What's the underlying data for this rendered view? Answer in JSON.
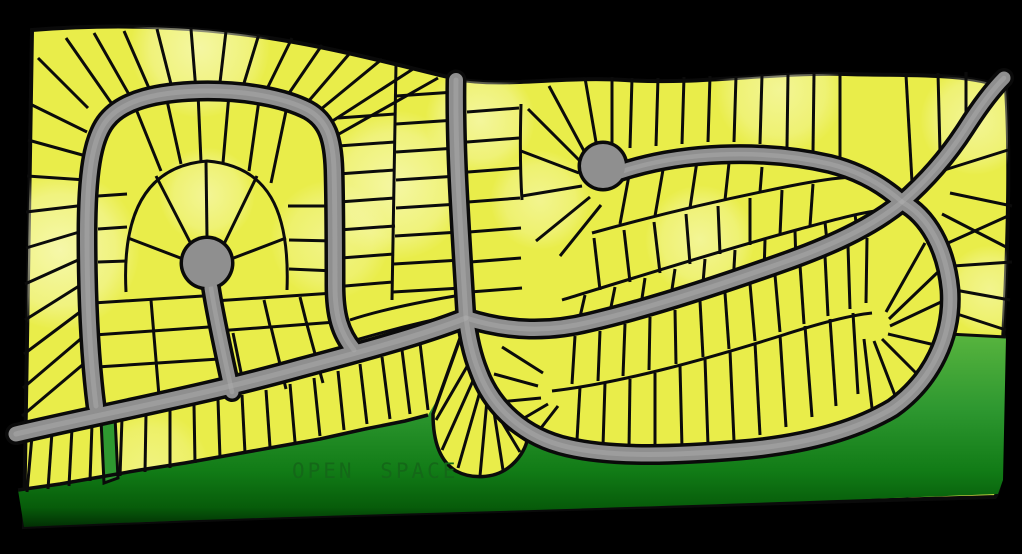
{
  "open_space": {
    "label": "OPEN SPACE"
  },
  "colors": {
    "background": "#000000",
    "lot_fill": "#e9ed4a",
    "lot_line": "#0b0b0b",
    "pale": "#fbfcd2",
    "road_fill": "#8f8f8f",
    "road_casing": "#0a0a0a",
    "road_highlight": "#aaaaaa",
    "green_mid": "#2e9830",
    "label_text": "#146818"
  },
  "map": {
    "width": 1022,
    "height": 554,
    "label_pos": {
      "x": 292,
      "y": 478
    },
    "plat_path": "M 32 30 C 120 23 205 27 282 40 C 342 50 402 66 456 79 C 505 88 560 76 625 80 C 700 85 770 72 845 74 C 905 76 965 72 1006 88 C 1010 150 1008 240 1004 320 C 1001 380 1000 430 1000 472 C 1000 483 999 492 995 497 C 900 499 700 505 500 511 C 350 515 180 520 24 527 C 25 440 28 250 32 30 Z",
    "green_path": "M 18 490 L 60 484 L 100 477 L 140 470 L 185 463 L 230 455 L 275 447 L 320 439 L 365 429 L 405 421 L 428 415 L 437 400 L 450 382 L 459 352 L 463 330 L 470 352 L 479 382 L 493 410 L 516 432 L 546 446 L 582 454 L 622 457 L 667 456 L 712 450 L 757 441 L 801 428 L 841 411 L 876 389 L 906 358 L 926 330 L 948 333 L 1006 337 L 1003 480 L 998 494 C 900 498 700 505 500 511 C 350 515 180 520 24 527 Z",
    "green_stops": [
      [
        "0%",
        "#5ab63f"
      ],
      [
        "40%",
        "#2e9830"
      ],
      [
        "72%",
        "#117b16"
      ],
      [
        "90%",
        "#075c0a"
      ],
      [
        "100%",
        "#022f04"
      ]
    ],
    "green_strip_path": "M 101 420 L 115 417 L 118 478 L 104 483 Z",
    "racetrack_path": "M 466 318 C 510 332 550 332 590 322 C 650 308 720 285 790 260 C 840 242 875 224 902 202 C 928 216 946 248 950 290 C 953 336 932 380 893 408 C 853 432 800 445 740 450 C 680 455 615 458 568 447 C 523 437 492 407 479 372 C 471 352 468 334 466 318 Z",
    "fan_path": "M 463 330 L 433 414 C 433 443 441 462 456 471 C 471 479 493 479 508 468 C 519 460 525 449 527 441 L 510 429 C 499 409 489 389 483 369 Z",
    "green_boundary_path": "M 18 490 L 60 484 L 100 477 L 140 470 L 185 463 L 230 455 L 275 447 L 320 439 L 365 429 L 405 421 L 428 415",
    "block_lines": [
      "M 126 292 C 122 215 145 166 207 161 C 268 166 290 210 287 290",
      "M 552 391 C 620 383 700 361 780 336 C 820 323 852 315 872 313",
      "M 562 300 C 640 276 730 248 800 229 C 830 221 855 214 875 211",
      "M 592 233 C 660 214 730 198 790 186 C 815 181 835 178 852 177",
      "M 396 64 L 392 300",
      "M 350 320 C 380 310 420 302 455 296",
      "M 356 340 C 390 330 430 320 462 314",
      "M 521 104 C 520 140 520 170 522 200",
      "M 948 334 L 1006 337"
    ],
    "lot_lines": [
      [
        88,
        108,
        38,
        58
      ],
      [
        87,
        132,
        30,
        104
      ],
      [
        86,
        156,
        28,
        140
      ],
      [
        86,
        180,
        27,
        176
      ],
      [
        86,
        205,
        26,
        212
      ],
      [
        86,
        230,
        26,
        248
      ],
      [
        87,
        256,
        25,
        284
      ],
      [
        87,
        281,
        25,
        320
      ],
      [
        88,
        306,
        24,
        354
      ],
      [
        90,
        331,
        23,
        388
      ],
      [
        93,
        356,
        22,
        416
      ],
      [
        112,
        104,
        66,
        38
      ],
      [
        131,
        98,
        94,
        33
      ],
      [
        152,
        95,
        124,
        31
      ],
      [
        173,
        92,
        157,
        29
      ],
      [
        196,
        91,
        191,
        29
      ],
      [
        219,
        91,
        226,
        31
      ],
      [
        241,
        93,
        259,
        34
      ],
      [
        263,
        97,
        292,
        38
      ],
      [
        283,
        102,
        322,
        45
      ],
      [
        301,
        110,
        350,
        53
      ],
      [
        309,
        119,
        382,
        59
      ],
      [
        317,
        131,
        413,
        69
      ],
      [
        323,
        143,
        438,
        78
      ],
      [
        338,
        118,
        395,
        114
      ],
      [
        338,
        146,
        395,
        142
      ],
      [
        338,
        174,
        395,
        170
      ],
      [
        339,
        202,
        395,
        198
      ],
      [
        339,
        230,
        395,
        226
      ],
      [
        341,
        258,
        394,
        254
      ],
      [
        345,
        286,
        393,
        282
      ],
      [
        396,
        96,
        455,
        92
      ],
      [
        396,
        124,
        456,
        120
      ],
      [
        396,
        152,
        457,
        148
      ],
      [
        396,
        180,
        458,
        176
      ],
      [
        396,
        208,
        459,
        204
      ],
      [
        395,
        236,
        460,
        232
      ],
      [
        394,
        264,
        461,
        260
      ],
      [
        393,
        292,
        462,
        288
      ],
      [
        207,
        237,
        206,
        162
      ],
      [
        191,
        244,
        156,
        176
      ],
      [
        183,
        259,
        128,
        238
      ],
      [
        224,
        244,
        257,
        176
      ],
      [
        231,
        259,
        286,
        238
      ],
      [
        93,
        303,
        203,
        296
      ],
      [
        94,
        335,
        209,
        327
      ],
      [
        97,
        367,
        219,
        359
      ],
      [
        151,
        300,
        159,
        396
      ],
      [
        214,
        301,
        334,
        293
      ],
      [
        217,
        331,
        336,
        322
      ],
      [
        264,
        300,
        270,
        326
      ],
      [
        300,
        297,
        306,
        321
      ],
      [
        233,
        333,
        245,
        392
      ],
      [
        271,
        327,
        286,
        389
      ],
      [
        306,
        321,
        323,
        383
      ],
      [
        98,
        196,
        127,
        194
      ],
      [
        98,
        229,
        127,
        227
      ],
      [
        98,
        262,
        127,
        261
      ],
      [
        136,
        109,
        161,
        171
      ],
      [
        166,
        96,
        181,
        164
      ],
      [
        198,
        93,
        201,
        162
      ],
      [
        229,
        94,
        223,
        163
      ],
      [
        259,
        100,
        249,
        171
      ],
      [
        286,
        111,
        271,
        183
      ],
      [
        333,
        206,
        288,
        206
      ],
      [
        335,
        241,
        289,
        240
      ],
      [
        335,
        271,
        289,
        269
      ],
      [
        32,
        436,
        27,
        492
      ],
      [
        52,
        432,
        48,
        489
      ],
      [
        72,
        428,
        69,
        486
      ],
      [
        92,
        424,
        90,
        481
      ],
      [
        122,
        418,
        120,
        476
      ],
      [
        146,
        414,
        145,
        472
      ],
      [
        170,
        410,
        170,
        468
      ],
      [
        194,
        405,
        195,
        463
      ],
      [
        218,
        400,
        220,
        458
      ],
      [
        242,
        395,
        245,
        453
      ],
      [
        266,
        390,
        270,
        447
      ],
      [
        290,
        384,
        295,
        442
      ],
      [
        314,
        378,
        320,
        436
      ],
      [
        338,
        371,
        344,
        430
      ],
      [
        360,
        364,
        367,
        424
      ],
      [
        382,
        357,
        390,
        419
      ],
      [
        402,
        350,
        410,
        414
      ],
      [
        420,
        343,
        428,
        410
      ],
      [
        472,
        358,
        436,
        420
      ],
      [
        476,
        374,
        442,
        450
      ],
      [
        481,
        388,
        458,
        468
      ],
      [
        487,
        400,
        480,
        476
      ],
      [
        494,
        412,
        503,
        470
      ],
      [
        502,
        422,
        520,
        452
      ],
      [
        575,
        336,
        572,
        384
      ],
      [
        600,
        331,
        598,
        381
      ],
      [
        625,
        324,
        623,
        376
      ],
      [
        650,
        317,
        649,
        370
      ],
      [
        675,
        310,
        676,
        364
      ],
      [
        700,
        301,
        703,
        357
      ],
      [
        725,
        293,
        729,
        349
      ],
      [
        750,
        284,
        755,
        341
      ],
      [
        775,
        275,
        780,
        332
      ],
      [
        800,
        265,
        804,
        324
      ],
      [
        825,
        256,
        828,
        316
      ],
      [
        848,
        246,
        850,
        309
      ],
      [
        867,
        238,
        866,
        303
      ],
      [
        580,
        387,
        577,
        440
      ],
      [
        605,
        383,
        603,
        446
      ],
      [
        630,
        379,
        629,
        449
      ],
      [
        655,
        373,
        655,
        449
      ],
      [
        680,
        366,
        682,
        448
      ],
      [
        705,
        359,
        708,
        445
      ],
      [
        730,
        351,
        734,
        441
      ],
      [
        755,
        343,
        760,
        435
      ],
      [
        780,
        335,
        786,
        427
      ],
      [
        805,
        326,
        812,
        417
      ],
      [
        830,
        319,
        836,
        406
      ],
      [
        853,
        313,
        858,
        394
      ],
      [
        543,
        373,
        502,
        347
      ],
      [
        538,
        386,
        494,
        374
      ],
      [
        541,
        398,
        499,
        402
      ],
      [
        548,
        404,
        514,
        424
      ],
      [
        558,
        406,
        534,
        437
      ],
      [
        886,
        312,
        925,
        243
      ],
      [
        889,
        319,
        938,
        272
      ],
      [
        890,
        326,
        941,
        302
      ],
      [
        888,
        334,
        935,
        345
      ],
      [
        882,
        339,
        918,
        375
      ],
      [
        874,
        341,
        896,
        398
      ],
      [
        864,
        339,
        872,
        408
      ],
      [
        585,
        295,
        577,
        330
      ],
      [
        615,
        287,
        608,
        322
      ],
      [
        645,
        278,
        640,
        312
      ],
      [
        675,
        269,
        670,
        303
      ],
      [
        705,
        259,
        702,
        295
      ],
      [
        735,
        250,
        733,
        285
      ],
      [
        765,
        240,
        764,
        274
      ],
      [
        795,
        231,
        796,
        263
      ],
      [
        825,
        222,
        828,
        252
      ],
      [
        855,
        214,
        858,
        240
      ],
      [
        600,
        290,
        594,
        238
      ],
      [
        630,
        282,
        624,
        230
      ],
      [
        660,
        273,
        654,
        222
      ],
      [
        690,
        264,
        686,
        214
      ],
      [
        720,
        254,
        718,
        206
      ],
      [
        750,
        245,
        750,
        198
      ],
      [
        780,
        235,
        782,
        190
      ],
      [
        810,
        226,
        813,
        184
      ],
      [
        620,
        224,
        630,
        170
      ],
      [
        655,
        216,
        664,
        164
      ],
      [
        690,
        208,
        697,
        161
      ],
      [
        725,
        200,
        729,
        163
      ],
      [
        760,
        192,
        762,
        167
      ],
      [
        632,
        78,
        630,
        148
      ],
      [
        658,
        78,
        656,
        146
      ],
      [
        684,
        77,
        682,
        144
      ],
      [
        710,
        76,
        708,
        142
      ],
      [
        736,
        76,
        734,
        142
      ],
      [
        762,
        75,
        760,
        144
      ],
      [
        788,
        74,
        787,
        147
      ],
      [
        814,
        74,
        813,
        152
      ],
      [
        840,
        74,
        840,
        157
      ],
      [
        912,
        182,
        906,
        75
      ],
      [
        940,
        152,
        938,
        73
      ],
      [
        966,
        122,
        966,
        72
      ],
      [
        938,
        172,
        1008,
        150
      ],
      [
        950,
        193,
        1012,
        206
      ],
      [
        942,
        214,
        1008,
        248
      ],
      [
        948,
        243,
        1008,
        216
      ],
      [
        953,
        266,
        1012,
        262
      ],
      [
        955,
        290,
        1010,
        300
      ],
      [
        951,
        312,
        1006,
        330
      ],
      [
        596,
        142,
        585,
        78
      ],
      [
        612,
        143,
        612,
        77
      ],
      [
        584,
        151,
        549,
        86
      ],
      [
        580,
        161,
        528,
        109
      ],
      [
        579,
        173,
        521,
        151
      ],
      [
        582,
        186,
        522,
        196
      ],
      [
        590,
        197,
        536,
        241
      ],
      [
        601,
        205,
        560,
        256
      ],
      [
        467,
        112,
        519,
        108
      ],
      [
        467,
        142,
        519,
        138
      ],
      [
        468,
        172,
        520,
        168
      ],
      [
        468,
        202,
        520,
        198
      ],
      [
        469,
        232,
        521,
        228
      ],
      [
        470,
        262,
        521,
        258
      ],
      [
        470,
        292,
        522,
        288
      ]
    ],
    "roads": [
      {
        "name": "main-collector-road",
        "d": "M 16 434 C 100 414 200 396 300 368 C 360 352 420 336 466 318",
        "w": 15
      },
      {
        "name": "north-street",
        "d": "M 456 80 C 455 150 460 220 466 318",
        "w": 14
      },
      {
        "name": "west-loop-street",
        "d": "M 96 406 C 89 350 87 290 87 235 C 87 175 92 138 107 120 C 124 99 160 92 200 91 C 245 90 285 98 308 110 C 328 121 333 140 334 170 C 335 205 335 250 335 285 C 335 315 340 333 354 350",
        "w": 14
      },
      {
        "name": "west-culdesac-stem",
        "d": "M 232 392 C 224 355 216 320 211 288",
        "w": 13
      },
      {
        "name": "east-culdesac-street",
        "d": "M 620 172 C 680 152 760 148 830 164 C 858 171 882 184 902 202",
        "w": 13
      },
      {
        "name": "northeast-exit-road",
        "d": "M 902 202 C 925 182 948 156 966 128 C 980 106 992 90 1004 78",
        "w": 13
      },
      {
        "name": "racetrack-loop-street",
        "d": "M 466 318 C 510 332 550 332 590 322 C 650 308 720 285 790 260 C 840 242 875 224 902 202 C 928 216 946 248 950 290 C 953 336 932 380 893 408 C 853 432 800 445 740 450 C 680 455 615 458 568 447 C 523 437 492 407 479 372 C 471 352 468 334 466 318",
        "w": 14
      }
    ],
    "culdesacs": [
      {
        "name": "west-culdesac-bulb",
        "cx": 207,
        "cy": 263,
        "r": 24
      },
      {
        "name": "east-culdesac-bulb",
        "cx": 603,
        "cy": 166,
        "r": 22
      }
    ],
    "pale_spots": [
      [
        60,
        250,
        80,
        0.7
      ],
      [
        200,
        48,
        70,
        0.65
      ],
      [
        395,
        185,
        75,
        0.65
      ],
      [
        480,
        120,
        55,
        0.6
      ],
      [
        207,
        195,
        48,
        0.55
      ],
      [
        640,
        390,
        55,
        0.55
      ],
      [
        760,
        350,
        55,
        0.55
      ],
      [
        860,
        320,
        45,
        0.5
      ],
      [
        700,
        240,
        55,
        0.55
      ],
      [
        780,
        90,
        65,
        0.55
      ],
      [
        975,
        120,
        55,
        0.55
      ],
      [
        990,
        290,
        45,
        0.5
      ],
      [
        150,
        470,
        60,
        0.4
      ],
      [
        470,
        450,
        38,
        0.45
      ],
      [
        330,
        240,
        60,
        0.45
      ],
      [
        540,
        200,
        50,
        0.5
      ]
    ]
  }
}
